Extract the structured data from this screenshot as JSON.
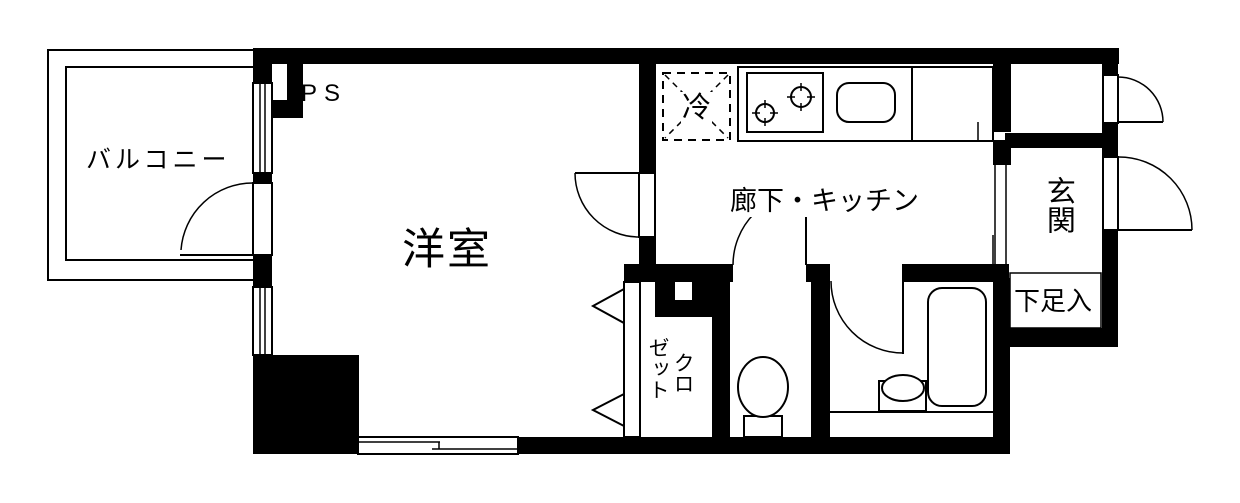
{
  "canvas": {
    "width": 1240,
    "height": 503,
    "background_color": "#ffffff",
    "wall_color": "#000000",
    "line_color": "#000000"
  },
  "floor_plan": {
    "type": "apartment-floor-plan",
    "labels": {
      "balcony": "バルコニー",
      "pipe_space": "PS",
      "western_room": "洋室",
      "refrigerator_space": "冷",
      "hallway_kitchen": "廊下・キッチン",
      "entrance": "玄関",
      "shoe_cabinet": "下足入",
      "closet_full": "クロゼット",
      "closet_column_right": "クロ",
      "closet_column_left": "ゼット"
    },
    "fixture_icons": [
      "refrigerator-space-icon",
      "stove-two-burner-icon",
      "kitchen-sink-icon",
      "bathtub-icon",
      "washbasin-icon",
      "toilet-icon",
      "sliding-window-icon",
      "swing-door-icon",
      "folding-closet-door-icon"
    ]
  }
}
